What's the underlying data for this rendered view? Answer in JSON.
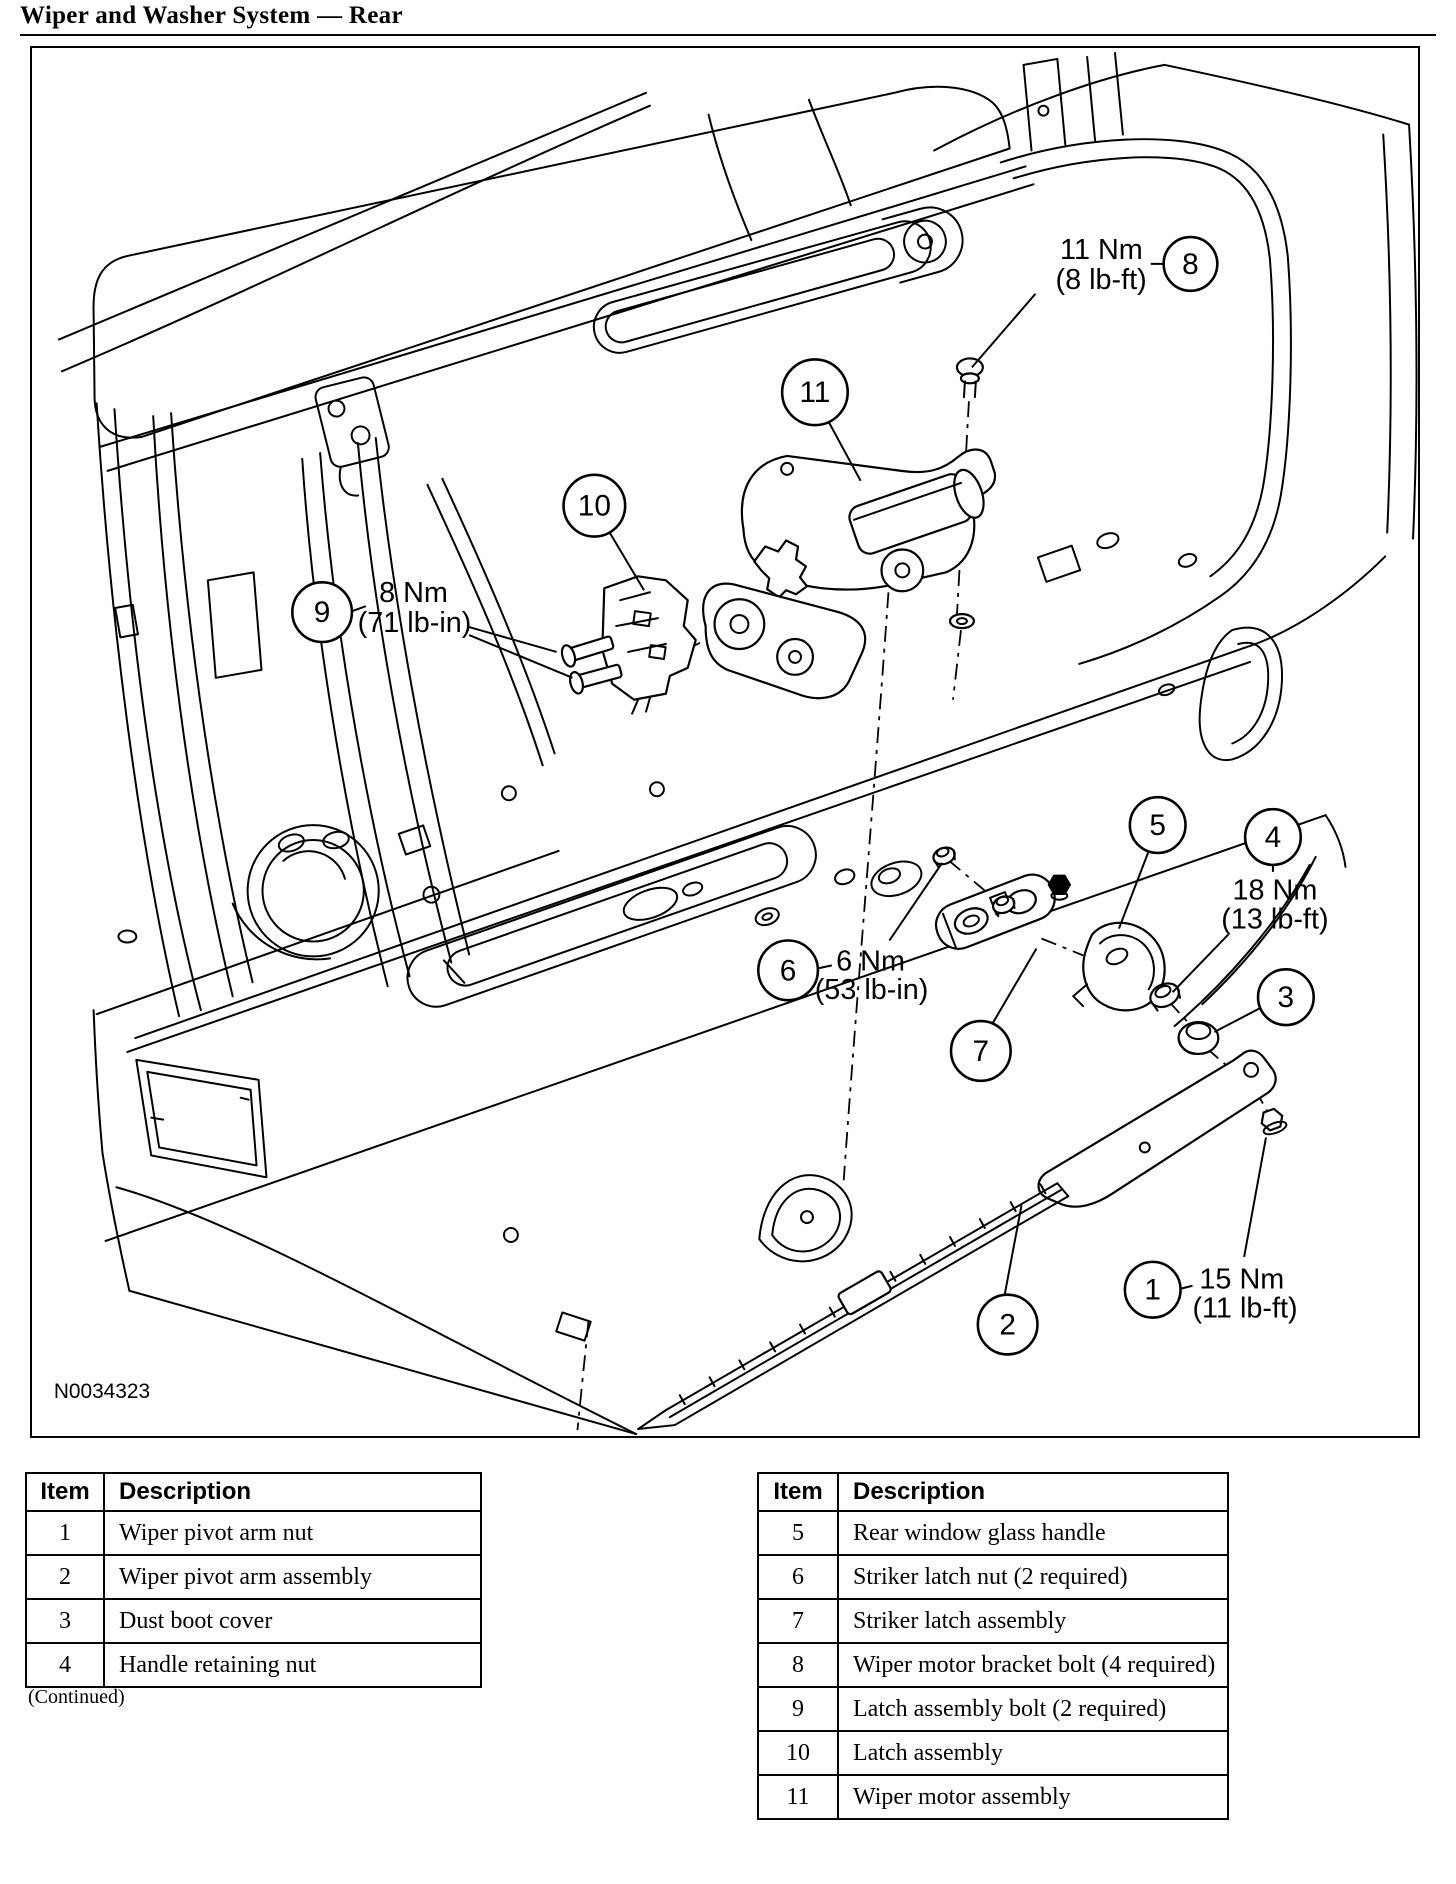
{
  "page": {
    "title": "Wiper and Washer System — Rear",
    "figure_id": "N0034323"
  },
  "diagram": {
    "callouts": [
      {
        "label": "1"
      },
      {
        "label": "2"
      },
      {
        "label": "3"
      },
      {
        "label": "4"
      },
      {
        "label": "5"
      },
      {
        "label": "6"
      },
      {
        "label": "7"
      },
      {
        "label": "8"
      },
      {
        "label": "9"
      },
      {
        "label": "10"
      },
      {
        "label": "11"
      }
    ],
    "torque_labels": [
      {
        "for_callout": "8",
        "value": "11 Nm",
        "alt": "(8 lb-ft)"
      },
      {
        "for_callout": "9",
        "value": "8 Nm",
        "alt": "(71 lb-in)"
      },
      {
        "for_callout": "4",
        "value": "18 Nm",
        "alt": "(13 lb-ft)"
      },
      {
        "for_callout": "6",
        "value": "6 Nm",
        "alt": "(53 lb-in)"
      },
      {
        "for_callout": "1",
        "value": "15 Nm",
        "alt": "(11 lb-ft)"
      }
    ]
  },
  "tables": {
    "left": {
      "headers": [
        "Item",
        "Description"
      ],
      "rows": [
        [
          "1",
          "Wiper pivot arm nut"
        ],
        [
          "2",
          "Wiper pivot arm assembly"
        ],
        [
          "3",
          "Dust boot cover"
        ],
        [
          "4",
          "Handle retaining nut"
        ]
      ],
      "footnote": "(Continued)"
    },
    "right": {
      "headers": [
        "Item",
        "Description"
      ],
      "rows": [
        [
          "5",
          "Rear window glass handle"
        ],
        [
          "6",
          "Striker latch nut (2 required)"
        ],
        [
          "7",
          "Striker latch assembly"
        ],
        [
          "8",
          "Wiper motor bracket bolt (4 required)"
        ],
        [
          "9",
          "Latch assembly bolt (2 required)"
        ],
        [
          "10",
          "Latch assembly"
        ],
        [
          "11",
          "Wiper motor assembly"
        ]
      ]
    }
  }
}
